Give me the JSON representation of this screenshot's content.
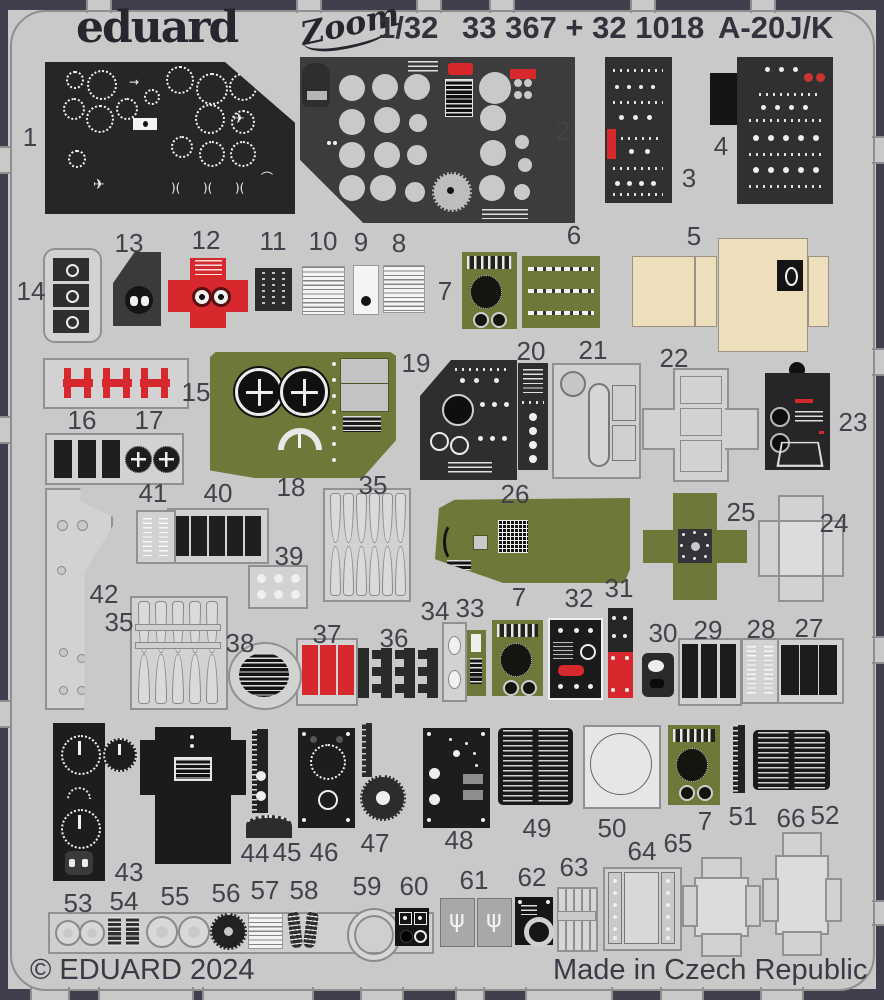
{
  "header": {
    "brand": "eduard",
    "brand_sub": "Zoom",
    "scale": "1/32",
    "catalog": "33 367 + 32 1018",
    "subject": "A-20J/K"
  },
  "footer": {
    "copyright": "© EDUARD 2024",
    "made_in": "Made in Czech Republic"
  },
  "colors": {
    "background": "#3f3f4d",
    "fret": "#c9c9c9",
    "panel_dark": "#2a2a2a",
    "olive": "#6f7838",
    "red": "#d7292d",
    "tan": "#eedfbc"
  },
  "part_labels": [
    {
      "n": "1",
      "x": 30,
      "y": 137
    },
    {
      "n": "2",
      "x": 563,
      "y": 131
    },
    {
      "n": "3",
      "x": 689,
      "y": 178
    },
    {
      "n": "4",
      "x": 721,
      "y": 146
    },
    {
      "n": "5",
      "x": 694,
      "y": 236
    },
    {
      "n": "6",
      "x": 574,
      "y": 235
    },
    {
      "n": "7",
      "x": 445,
      "y": 291
    },
    {
      "n": "8",
      "x": 399,
      "y": 243
    },
    {
      "n": "9",
      "x": 361,
      "y": 242
    },
    {
      "n": "10",
      "x": 323,
      "y": 241
    },
    {
      "n": "11",
      "x": 273,
      "y": 241
    },
    {
      "n": "12",
      "x": 206,
      "y": 240
    },
    {
      "n": "13",
      "x": 129,
      "y": 243
    },
    {
      "n": "14",
      "x": 31,
      "y": 291
    },
    {
      "n": "15",
      "x": 196,
      "y": 392
    },
    {
      "n": "16",
      "x": 82,
      "y": 420
    },
    {
      "n": "17",
      "x": 149,
      "y": 420
    },
    {
      "n": "18",
      "x": 291,
      "y": 487
    },
    {
      "n": "19",
      "x": 416,
      "y": 363
    },
    {
      "n": "20",
      "x": 531,
      "y": 351
    },
    {
      "n": "21",
      "x": 593,
      "y": 350
    },
    {
      "n": "22",
      "x": 674,
      "y": 358
    },
    {
      "n": "23",
      "x": 853,
      "y": 422
    },
    {
      "n": "24",
      "x": 834,
      "y": 523
    },
    {
      "n": "25",
      "x": 741,
      "y": 512
    },
    {
      "n": "26",
      "x": 515,
      "y": 494
    },
    {
      "n": "27",
      "x": 809,
      "y": 628
    },
    {
      "n": "28",
      "x": 761,
      "y": 629
    },
    {
      "n": "29",
      "x": 708,
      "y": 630
    },
    {
      "n": "30",
      "x": 663,
      "y": 633
    },
    {
      "n": "31",
      "x": 619,
      "y": 588
    },
    {
      "n": "32",
      "x": 579,
      "y": 598
    },
    {
      "n": "7",
      "x": 519,
      "y": 597
    },
    {
      "n": "33",
      "x": 470,
      "y": 608
    },
    {
      "n": "34",
      "x": 435,
      "y": 611
    },
    {
      "n": "35",
      "x": 373,
      "y": 485
    },
    {
      "n": "35",
      "x": 119,
      "y": 622
    },
    {
      "n": "36",
      "x": 394,
      "y": 638
    },
    {
      "n": "37",
      "x": 327,
      "y": 634
    },
    {
      "n": "38",
      "x": 240,
      "y": 643
    },
    {
      "n": "39",
      "x": 289,
      "y": 556
    },
    {
      "n": "40",
      "x": 218,
      "y": 493
    },
    {
      "n": "41",
      "x": 153,
      "y": 493
    },
    {
      "n": "42",
      "x": 104,
      "y": 594
    },
    {
      "n": "43",
      "x": 129,
      "y": 872
    },
    {
      "n": "44",
      "x": 255,
      "y": 853
    },
    {
      "n": "45",
      "x": 287,
      "y": 852
    },
    {
      "n": "46",
      "x": 324,
      "y": 852
    },
    {
      "n": "47",
      "x": 375,
      "y": 843
    },
    {
      "n": "48",
      "x": 459,
      "y": 840
    },
    {
      "n": "49",
      "x": 537,
      "y": 828
    },
    {
      "n": "50",
      "x": 612,
      "y": 828
    },
    {
      "n": "7",
      "x": 705,
      "y": 821
    },
    {
      "n": "51",
      "x": 743,
      "y": 816
    },
    {
      "n": "66",
      "x": 791,
      "y": 818
    },
    {
      "n": "52",
      "x": 825,
      "y": 815
    },
    {
      "n": "53",
      "x": 78,
      "y": 903
    },
    {
      "n": "54",
      "x": 124,
      "y": 901
    },
    {
      "n": "55",
      "x": 175,
      "y": 896
    },
    {
      "n": "56",
      "x": 226,
      "y": 893
    },
    {
      "n": "57",
      "x": 265,
      "y": 890
    },
    {
      "n": "58",
      "x": 304,
      "y": 890
    },
    {
      "n": "59",
      "x": 367,
      "y": 886
    },
    {
      "n": "60",
      "x": 414,
      "y": 886
    },
    {
      "n": "61",
      "x": 474,
      "y": 880
    },
    {
      "n": "62",
      "x": 532,
      "y": 877
    },
    {
      "n": "63",
      "x": 574,
      "y": 867
    },
    {
      "n": "64",
      "x": 642,
      "y": 851
    },
    {
      "n": "65",
      "x": 678,
      "y": 843
    }
  ]
}
